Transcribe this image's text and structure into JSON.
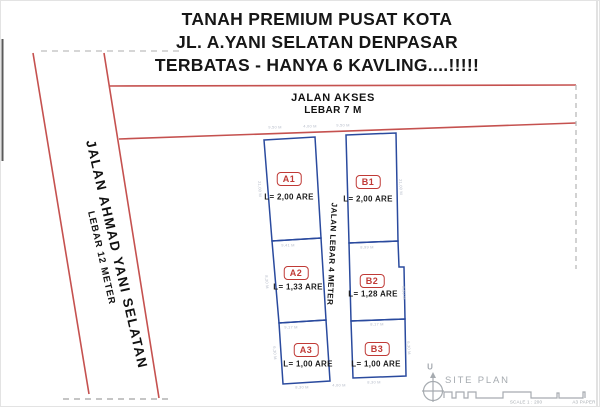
{
  "title": {
    "line1": "TANAH PREMIUM PUSAT KOTA",
    "line2": "JL. A.YANI SELATAN DENPASAR",
    "line3": "TERBATAS - HANYA 6 KAVLING....!!!!!"
  },
  "roads": {
    "access": {
      "name": "JALAN AKSES",
      "width_label": "LEBAR 7 M"
    },
    "main": {
      "name": "JALAN AHMAD YANI SELATAN",
      "width_label": "LEBAR 12 METER"
    },
    "internal": {
      "name": "JALAN LEBAR 4 METER"
    }
  },
  "plots": [
    {
      "id": "A1",
      "area": "L= 2,00 ARE"
    },
    {
      "id": "B1",
      "area": "L= 2,00 ARE"
    },
    {
      "id": "A2",
      "area": "L= 1,33 ARE"
    },
    {
      "id": "B2",
      "area": "L= 1,28 ARE"
    },
    {
      "id": "A3",
      "area": "L= 1,00 ARE"
    },
    {
      "id": "B3",
      "area": "L= 1,00 ARE"
    }
  ],
  "legend": {
    "north_label": "U",
    "site_plan_label": "SITE PLAN",
    "scale_label": "SCALE 1 : 200",
    "paper_label": "A3 PAPER"
  },
  "dims": [
    {
      "text": "9,50 M"
    },
    {
      "text": "4,00 M"
    },
    {
      "text": "9,50 M"
    },
    {
      "text": "9,41 M"
    },
    {
      "text": "8,99 M"
    },
    {
      "text": "9,17 M"
    },
    {
      "text": "8,17 M"
    },
    {
      "text": "8,30 M"
    },
    {
      "text": "4,00 M"
    },
    {
      "text": "8,30 M"
    },
    {
      "text": "21,00 M"
    },
    {
      "text": "21,00 M"
    },
    {
      "text": "8,20 M"
    },
    {
      "text": "8,50 M"
    },
    {
      "text": "6,30 M"
    },
    {
      "text": "6,30 M"
    }
  ],
  "colors": {
    "road_red": "#c5514f",
    "plot_blue": "#2a4a9e",
    "label_red": "#c03a36",
    "dim_gray": "#b6bcc9",
    "legend_gray": "#a6abb0"
  }
}
